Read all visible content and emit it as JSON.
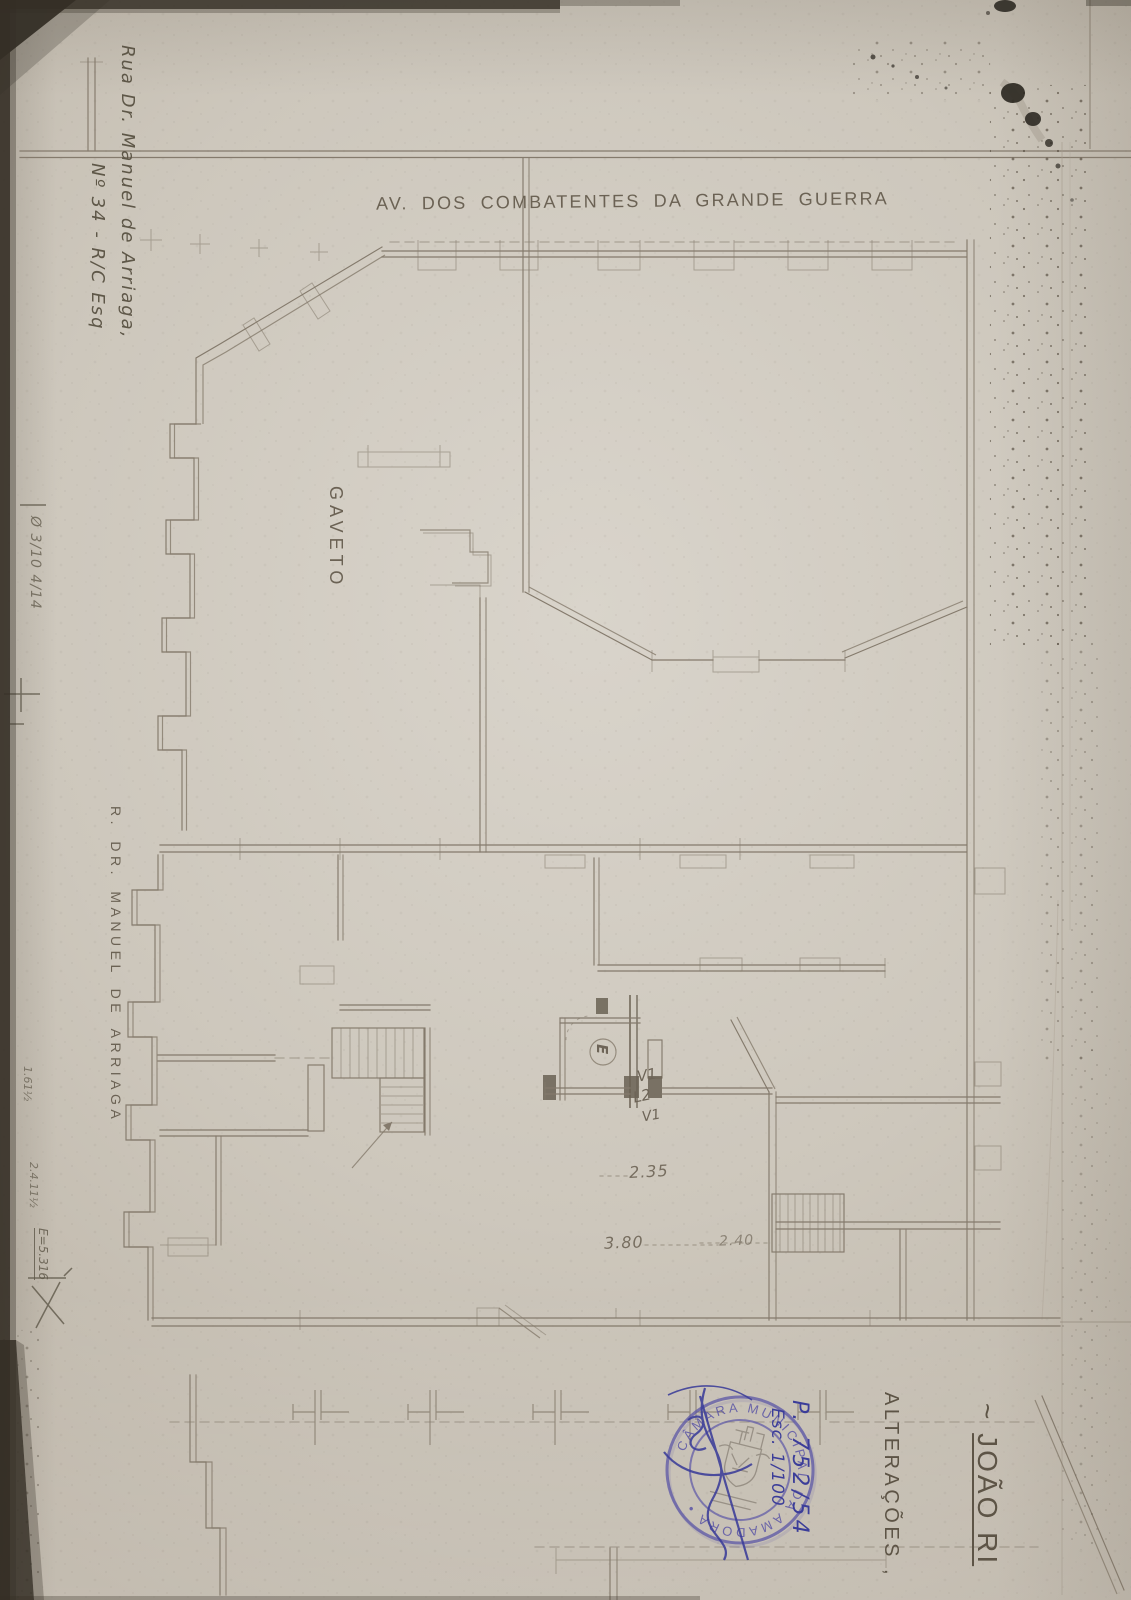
{
  "colors": {
    "paper": "#cdc7bc",
    "edge": "#352f26",
    "line": "#847a6c",
    "pencil": "#5e5748",
    "ink_blue": "#3b3d99",
    "stamp_violet": "#5b55a6"
  },
  "plan": {
    "avenue": "AV. DOS COMBATENTES DA GRANDE GUERRA",
    "corner": "GAVETO",
    "street": "R. DR. MANUEL DE ARRIAGA",
    "labels": {
      "v1_top": "V1",
      "l2": "L2",
      "v1_bottom": "V1",
      "entry": "E"
    },
    "dimensions": {
      "hall": "2.35",
      "front": "3.80",
      "steps": "2.40"
    }
  },
  "notes": {
    "address_line1": "Rua Dr. Manuel de Arriaga,",
    "address_line2": "Nº 34 - R/C Esq",
    "margin_top": "Ø 3/10 4/14",
    "margin_a": "1.61½",
    "margin_b": "2.4.11½",
    "margin_c": "E=5.316",
    "owner_prefix": "~",
    "owner": "JOÃO RI",
    "alterations": "ALTERAÇÕES ,",
    "process_number": "P. 752/54",
    "scale": "Esc. 1/100"
  },
  "stamp": {
    "arc_text": "CÂMARA MUNICIPAL DA AMADORA •"
  }
}
